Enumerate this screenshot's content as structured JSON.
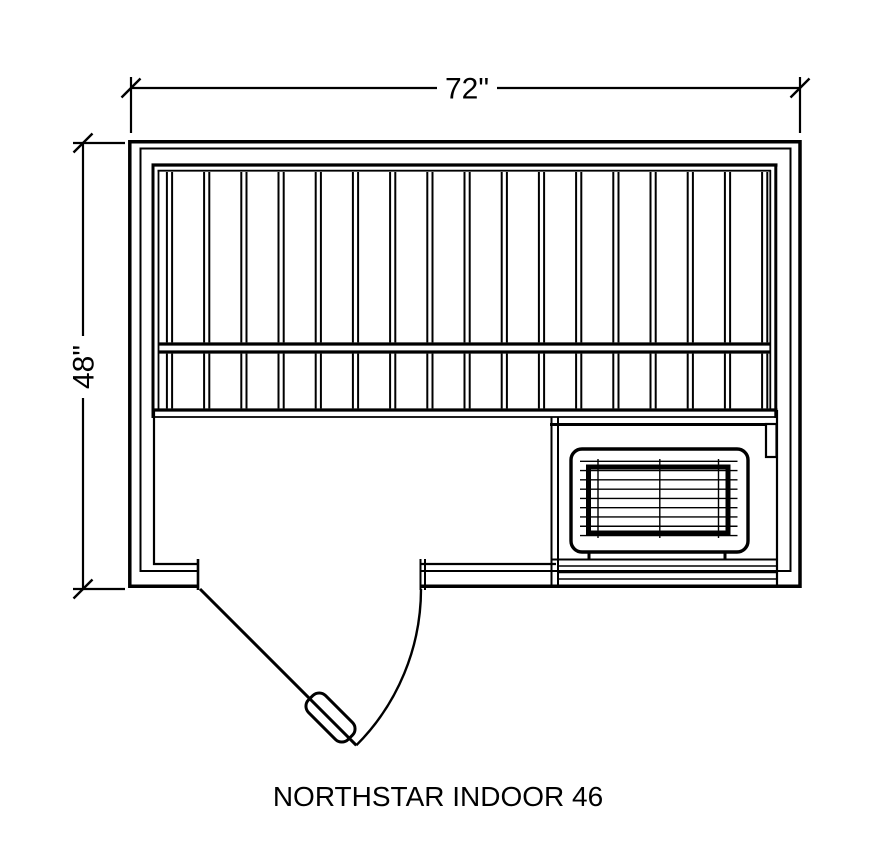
{
  "title": "NORTHSTAR INDOOR 46",
  "dimensions": {
    "width_label": "72\"",
    "height_label": "48\""
  },
  "colors": {
    "line": "#000000",
    "background": "#ffffff"
  },
  "plan": {
    "bench_slat_count": 17,
    "heater_grille_h_line_count": 9,
    "heater_grille_v_line_count": 3,
    "under_heater_line_count": 3
  }
}
